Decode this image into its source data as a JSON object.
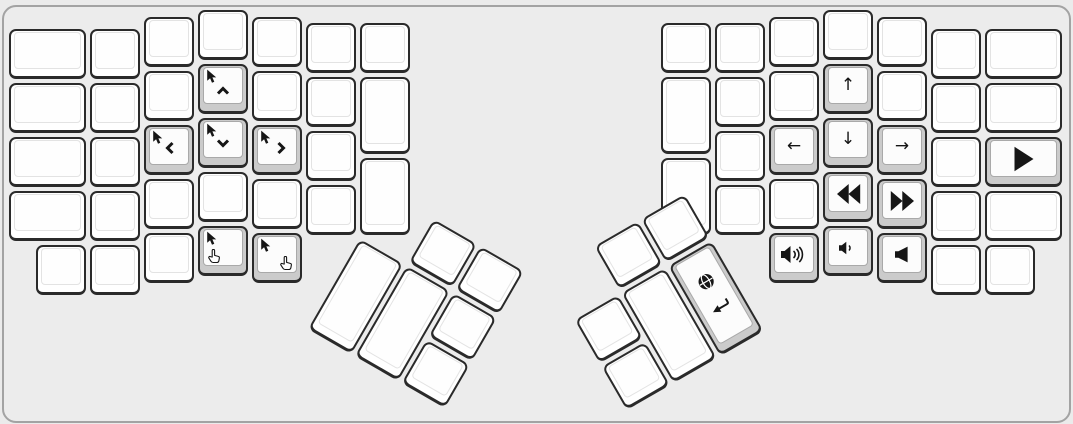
{
  "app": {
    "view": "split-keyboard-layer-preview",
    "visible_text": ""
  },
  "canvas": {
    "width": 1073,
    "height": 424,
    "background": "#ebebeb",
    "panel_border_color": "#a3a3a3",
    "panel_radius": 14
  },
  "colors": {
    "key_fill": "#ffffff",
    "key_border": "#2a2a2a",
    "held_key_fill": "#cbcbcb",
    "face_border": "#e3e3e3",
    "held_face_border": "#a9a9a9",
    "icon": "#161616"
  },
  "arrow_glyphs": {
    "arrow-up": "↑",
    "arrow-down": "↓",
    "arrow-left": "←",
    "arrow-right": "→"
  },
  "icon_names": [
    "mouse-cursor-icon",
    "chevron-up-icon",
    "chevron-down-icon",
    "chevron-left-icon",
    "chevron-right-icon",
    "hand-pointer-icon",
    "arrow-up-icon",
    "arrow-down-icon",
    "arrow-left-icon",
    "arrow-right-icon",
    "rewind-icon",
    "fast-forward-icon",
    "play-icon",
    "volume-up-icon",
    "volume-down-icon",
    "volume-mute-icon",
    "globe-icon",
    "return-icon"
  ],
  "main_keys": [
    {
      "n": "l-c1-r1",
      "x": 9,
      "y": 29,
      "w": 77,
      "h": 50
    },
    {
      "n": "l-c1-r2",
      "x": 9,
      "y": 83,
      "w": 77,
      "h": 50
    },
    {
      "n": "l-c1-r3",
      "x": 9,
      "y": 137,
      "w": 77,
      "h": 50
    },
    {
      "n": "l-c1-r4",
      "x": 9,
      "y": 191,
      "w": 77,
      "h": 50
    },
    {
      "n": "l-c2-r1",
      "x": 90,
      "y": 29,
      "w": 50,
      "h": 50
    },
    {
      "n": "l-c2-r2",
      "x": 90,
      "y": 83,
      "w": 50,
      "h": 50
    },
    {
      "n": "l-c2-r3",
      "x": 90,
      "y": 137,
      "w": 50,
      "h": 50
    },
    {
      "n": "l-c2-r4",
      "x": 90,
      "y": 191,
      "w": 50,
      "h": 50
    },
    {
      "n": "l-c3-r1",
      "x": 144,
      "y": 17,
      "w": 50,
      "h": 50
    },
    {
      "n": "l-c3-r2",
      "x": 144,
      "y": 71,
      "w": 50,
      "h": 50
    },
    {
      "n": "mouse-left",
      "x": 144,
      "y": 125,
      "w": 50,
      "h": 50,
      "held": true,
      "icon": "mouse-left"
    },
    {
      "n": "l-c3-r4",
      "x": 144,
      "y": 179,
      "w": 50,
      "h": 50
    },
    {
      "n": "l-c4-r1",
      "x": 198,
      "y": 10,
      "w": 50,
      "h": 50
    },
    {
      "n": "mouse-up",
      "x": 198,
      "y": 64,
      "w": 50,
      "h": 50,
      "held": true,
      "icon": "mouse-up"
    },
    {
      "n": "mouse-down",
      "x": 198,
      "y": 118,
      "w": 50,
      "h": 50,
      "held": true,
      "icon": "mouse-down"
    },
    {
      "n": "l-c4-r4",
      "x": 198,
      "y": 172,
      "w": 50,
      "h": 50
    },
    {
      "n": "l-c5-r1",
      "x": 252,
      "y": 17,
      "w": 50,
      "h": 50
    },
    {
      "n": "l-c5-r2",
      "x": 252,
      "y": 71,
      "w": 50,
      "h": 50
    },
    {
      "n": "mouse-right",
      "x": 252,
      "y": 125,
      "w": 50,
      "h": 50,
      "held": true,
      "icon": "mouse-right"
    },
    {
      "n": "l-c5-r4",
      "x": 252,
      "y": 179,
      "w": 50,
      "h": 50
    },
    {
      "n": "l-c6-r1",
      "x": 306,
      "y": 23,
      "w": 50,
      "h": 50
    },
    {
      "n": "l-c6-r2",
      "x": 306,
      "y": 77,
      "w": 50,
      "h": 50
    },
    {
      "n": "l-c6-r3",
      "x": 306,
      "y": 131,
      "w": 50,
      "h": 50
    },
    {
      "n": "l-c6-r4",
      "x": 306,
      "y": 185,
      "w": 50,
      "h": 50
    },
    {
      "n": "l-c7-r1",
      "x": 360,
      "y": 23,
      "w": 50,
      "h": 50
    },
    {
      "n": "l-c7-tall1",
      "x": 360,
      "y": 77,
      "w": 50,
      "h": 77
    },
    {
      "n": "l-c7-tall2",
      "x": 360,
      "y": 158,
      "w": 50,
      "h": 77
    },
    {
      "n": "l-bottom-1",
      "x": 36,
      "y": 245,
      "w": 50,
      "h": 50
    },
    {
      "n": "l-bottom-2",
      "x": 90,
      "y": 245,
      "w": 50,
      "h": 50
    },
    {
      "n": "l-bottom-3",
      "x": 144,
      "y": 233,
      "w": 50,
      "h": 50
    },
    {
      "n": "mouse-left-click",
      "x": 198,
      "y": 226,
      "w": 50,
      "h": 50,
      "held": true,
      "icon": "mouse-left-click"
    },
    {
      "n": "mouse-right-click",
      "x": 252,
      "y": 233,
      "w": 50,
      "h": 50,
      "held": true,
      "icon": "mouse-right-click"
    },
    {
      "n": "r-c1-r1",
      "x": 661,
      "y": 23,
      "w": 50,
      "h": 50
    },
    {
      "n": "r-c1-tall1",
      "x": 661,
      "y": 77,
      "w": 50,
      "h": 77
    },
    {
      "n": "r-c1-tall2",
      "x": 661,
      "y": 158,
      "w": 50,
      "h": 77
    },
    {
      "n": "r-c2-r1",
      "x": 715,
      "y": 23,
      "w": 50,
      "h": 50
    },
    {
      "n": "r-c2-r2",
      "x": 715,
      "y": 77,
      "w": 50,
      "h": 50
    },
    {
      "n": "r-c2-r3",
      "x": 715,
      "y": 131,
      "w": 50,
      "h": 50
    },
    {
      "n": "r-c2-r4",
      "x": 715,
      "y": 185,
      "w": 50,
      "h": 50
    },
    {
      "n": "r-c3-r1",
      "x": 769,
      "y": 17,
      "w": 50,
      "h": 50
    },
    {
      "n": "r-c3-r2",
      "x": 769,
      "y": 71,
      "w": 50,
      "h": 50
    },
    {
      "n": "arrow-left",
      "x": 769,
      "y": 125,
      "w": 50,
      "h": 50,
      "held": true,
      "icon": "arrow-left"
    },
    {
      "n": "r-c3-r4",
      "x": 769,
      "y": 179,
      "w": 50,
      "h": 50
    },
    {
      "n": "r-c4-r1",
      "x": 823,
      "y": 10,
      "w": 50,
      "h": 50
    },
    {
      "n": "arrow-up",
      "x": 823,
      "y": 64,
      "w": 50,
      "h": 50,
      "held": true,
      "icon": "arrow-up"
    },
    {
      "n": "arrow-down",
      "x": 823,
      "y": 118,
      "w": 50,
      "h": 50,
      "held": true,
      "icon": "arrow-down"
    },
    {
      "n": "rewind",
      "x": 823,
      "y": 172,
      "w": 50,
      "h": 50,
      "held": true,
      "icon": "rewind"
    },
    {
      "n": "r-c5-r1",
      "x": 877,
      "y": 17,
      "w": 50,
      "h": 50
    },
    {
      "n": "r-c5-r2",
      "x": 877,
      "y": 71,
      "w": 50,
      "h": 50
    },
    {
      "n": "arrow-right",
      "x": 877,
      "y": 125,
      "w": 50,
      "h": 50,
      "held": true,
      "icon": "arrow-right"
    },
    {
      "n": "fast-forward",
      "x": 877,
      "y": 179,
      "w": 50,
      "h": 50,
      "held": true,
      "icon": "fast-forward"
    },
    {
      "n": "r-c6-r1",
      "x": 931,
      "y": 29,
      "w": 50,
      "h": 50
    },
    {
      "n": "r-c6-r2",
      "x": 931,
      "y": 83,
      "w": 50,
      "h": 50
    },
    {
      "n": "r-c6-r3",
      "x": 931,
      "y": 137,
      "w": 50,
      "h": 50
    },
    {
      "n": "r-c6-r4",
      "x": 931,
      "y": 191,
      "w": 50,
      "h": 50
    },
    {
      "n": "r-c7-r1",
      "x": 985,
      "y": 29,
      "w": 77,
      "h": 50
    },
    {
      "n": "r-c7-r2",
      "x": 985,
      "y": 83,
      "w": 77,
      "h": 50
    },
    {
      "n": "play",
      "x": 985,
      "y": 137,
      "w": 77,
      "h": 50,
      "held": true,
      "icon": "play"
    },
    {
      "n": "r-c7-r4",
      "x": 985,
      "y": 191,
      "w": 77,
      "h": 50
    },
    {
      "n": "volume-up",
      "x": 769,
      "y": 233,
      "w": 50,
      "h": 50,
      "held": true,
      "icon": "volume-up"
    },
    {
      "n": "volume-down",
      "x": 823,
      "y": 226,
      "w": 50,
      "h": 50,
      "held": true,
      "icon": "volume-down"
    },
    {
      "n": "volume-mute",
      "x": 877,
      "y": 233,
      "w": 50,
      "h": 50,
      "held": true,
      "icon": "volume-mute"
    },
    {
      "n": "r-bottom-4",
      "x": 931,
      "y": 245,
      "w": 50,
      "h": 50
    },
    {
      "n": "r-bottom-5",
      "x": 985,
      "y": 245,
      "w": 50,
      "h": 50
    }
  ],
  "thumb_clusters": [
    {
      "name": "left-thumb-cluster",
      "pivot_x": 360,
      "pivot_y": 239,
      "rotation": 30,
      "keys": [
        {
          "n": "lt-upper-1",
          "x": 54,
          "y": -54,
          "w": 50,
          "h": 50
        },
        {
          "n": "lt-upper-2",
          "x": 108,
          "y": -54,
          "w": 50,
          "h": 50
        },
        {
          "n": "lt-tall-1",
          "x": 0,
          "y": 0,
          "w": 50,
          "h": 104
        },
        {
          "n": "lt-tall-2",
          "x": 54,
          "y": 0,
          "w": 50,
          "h": 104
        },
        {
          "n": "lt-side-1",
          "x": 108,
          "y": 0,
          "w": 50,
          "h": 50
        },
        {
          "n": "lt-side-2",
          "x": 108,
          "y": 54,
          "w": 50,
          "h": 50
        }
      ]
    },
    {
      "name": "right-thumb-cluster",
      "pivot_x": 715,
      "pivot_y": 239,
      "rotation": -30,
      "keys": [
        {
          "n": "rt-upper-1",
          "x": -108,
          "y": -54,
          "w": 50,
          "h": 50
        },
        {
          "n": "rt-upper-2",
          "x": -54,
          "y": -54,
          "w": 50,
          "h": 50
        },
        {
          "n": "rt-side-1",
          "x": -162,
          "y": 0,
          "w": 50,
          "h": 50
        },
        {
          "n": "rt-side-2",
          "x": -162,
          "y": 54,
          "w": 50,
          "h": 50
        },
        {
          "n": "rt-tall-1",
          "x": -108,
          "y": 0,
          "w": 50,
          "h": 104
        },
        {
          "n": "globe-return",
          "x": -54,
          "y": 0,
          "w": 50,
          "h": 104,
          "held": true,
          "icon": "globe-return"
        }
      ]
    }
  ]
}
